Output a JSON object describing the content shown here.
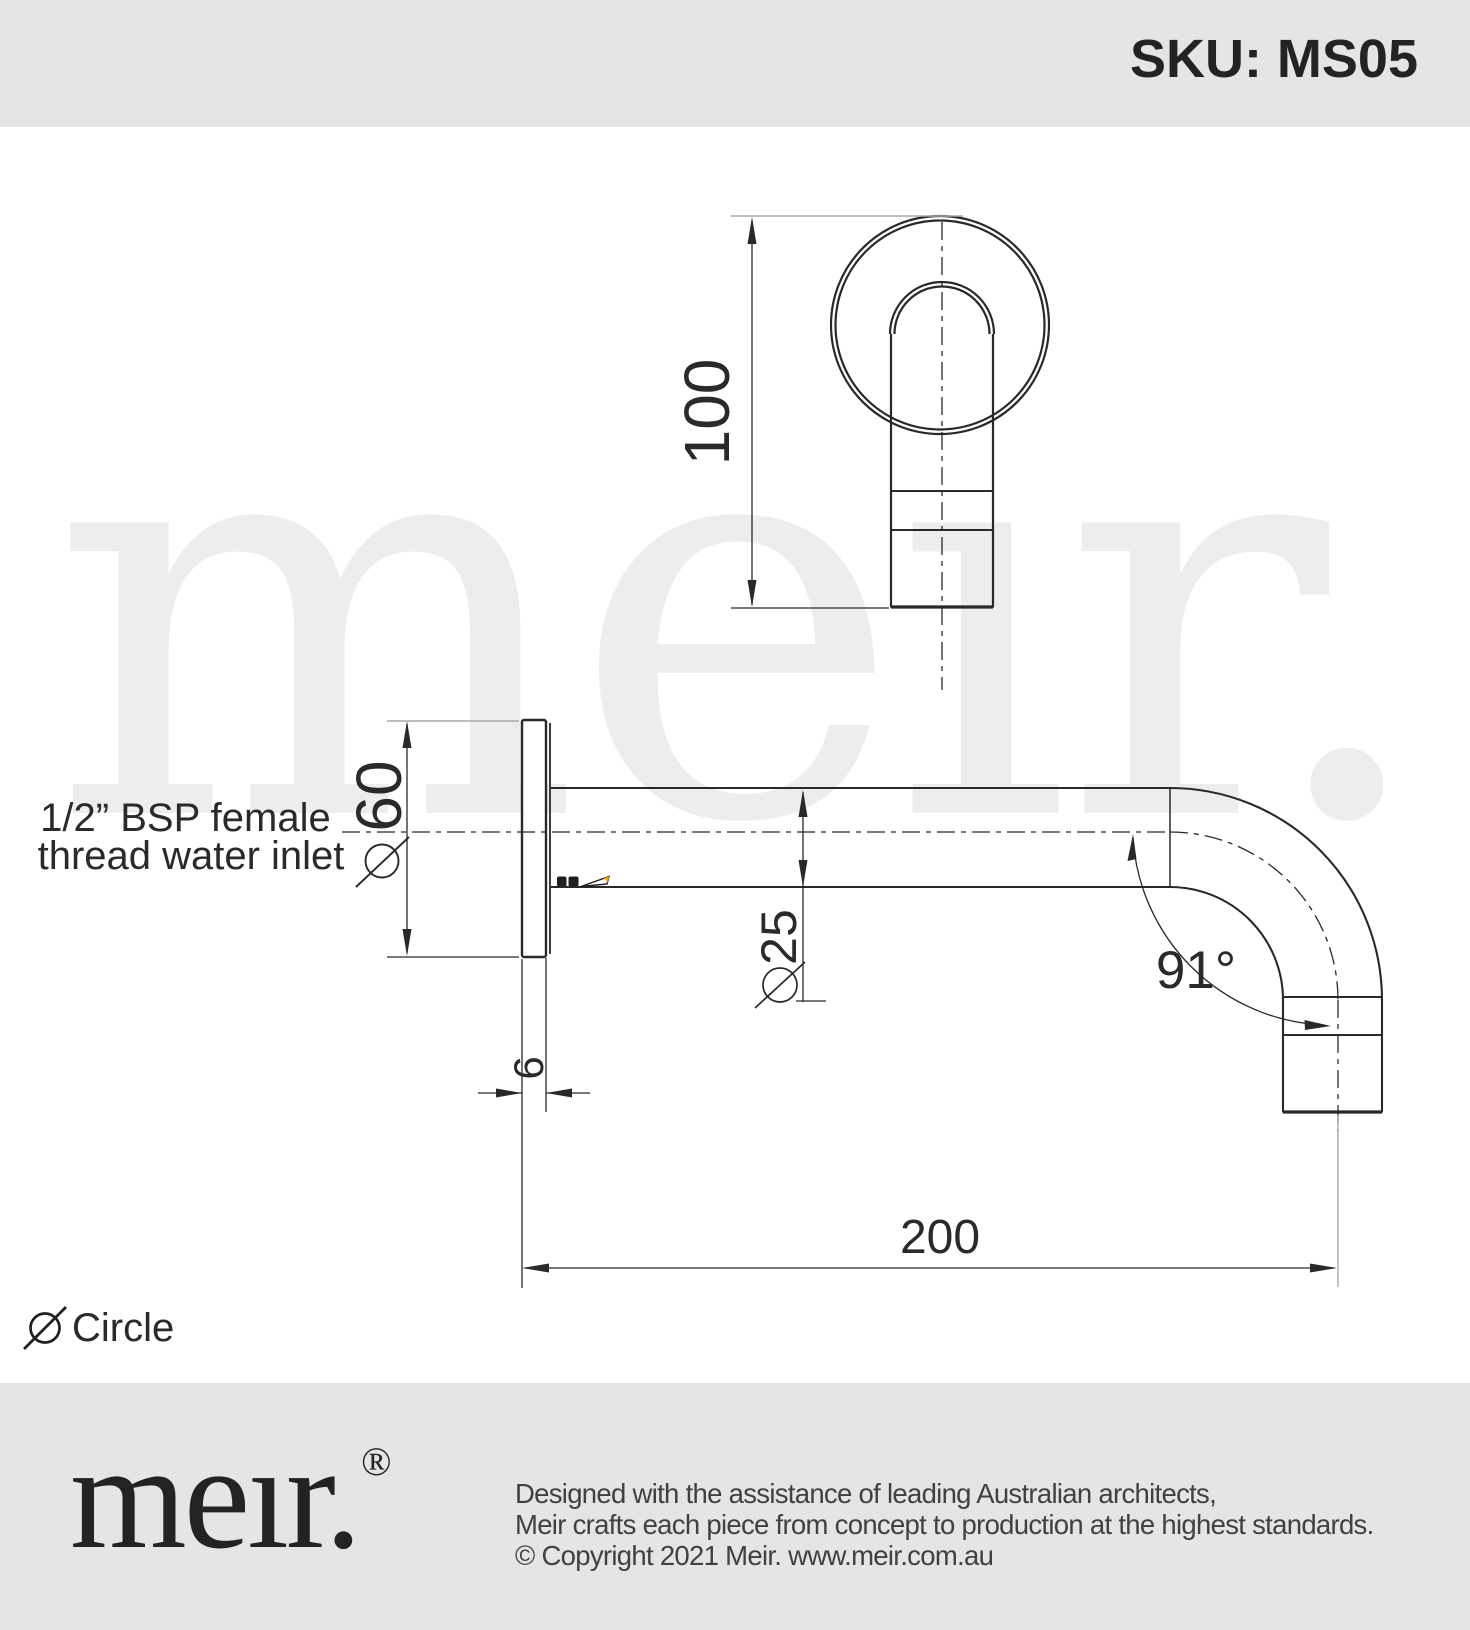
{
  "header": {
    "sku_label": "SKU: MS05"
  },
  "watermark": {
    "text": "meır."
  },
  "annotations": {
    "inlet_label_line1": "1/2” BSP female",
    "inlet_label_line2": "thread water inlet"
  },
  "dimensions": {
    "front_height": "100",
    "plate_diameter_symbol": "Ø",
    "plate_diameter": "60",
    "spout_diameter_symbol": "Ø",
    "spout_diameter": "25",
    "plate_thickness": "6",
    "spout_reach": "200",
    "bend_angle": "91°"
  },
  "legend": {
    "symbol": "Ø",
    "label": "Circle"
  },
  "footer": {
    "logo_text": "meır.",
    "logo_registered": "®",
    "line1": "Designed with the assistance of leading Australian architects,",
    "line2": "Meir crafts each piece from concept to production at the highest standards.",
    "line3": "© Copyright 2021 Meir. www.meir.com.au"
  },
  "colors": {
    "band_gray": "#e4e5e7",
    "line_dark": "#29282b",
    "extension_gray": "#a8a8aa",
    "watermark_gray": "#ededef",
    "pencil_orange": "#f0a500"
  }
}
